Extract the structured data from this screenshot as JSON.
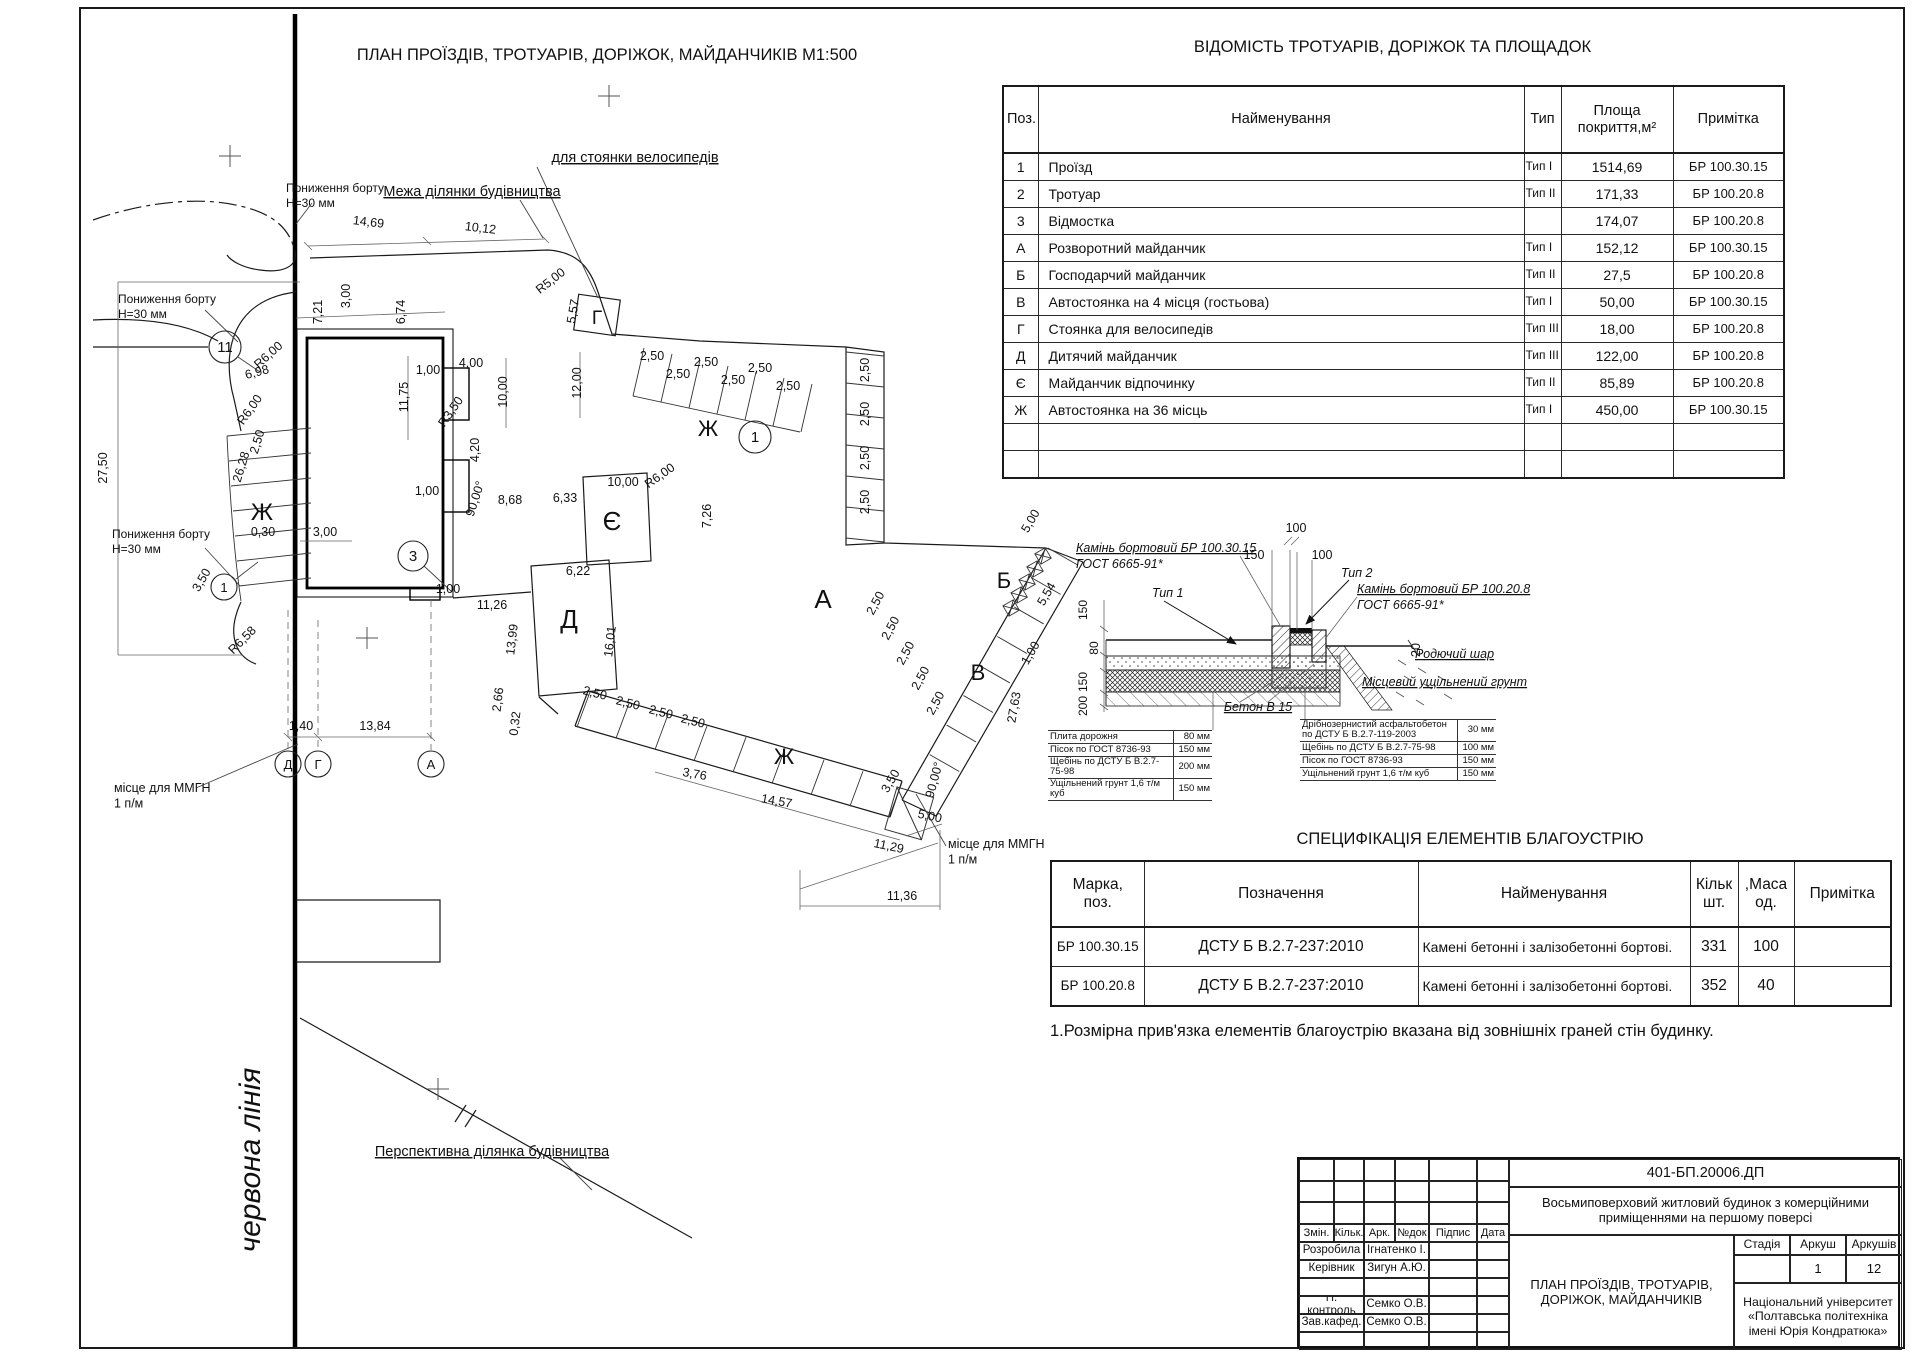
{
  "sheet": {
    "note": "1.Розмірна прив'язка елементів благоустрію вказана від зовнішніх граней стін будинку."
  },
  "plan": {
    "labels": [
      {
        "t": "ПЛАН ПРОЇЗДІВ, ТРОТУАРІВ, ДОРІЖОК, МАЙДАНЧИКІВ М1:500",
        "x": 607,
        "y": 60,
        "s": 16.5,
        "n": "plan-title"
      },
      {
        "t": "для стоянки велосипедів",
        "x": 635,
        "y": 162,
        "s": 14.5,
        "u": 1,
        "n": "callout-bike-parking"
      },
      {
        "t": "Межа ділянки будівництва",
        "x": 472,
        "y": 196,
        "s": 14.5,
        "u": 1,
        "n": "callout-site-boundary"
      },
      {
        "t": "Пониження борту\nН=30 мм",
        "x": 286,
        "y": 192,
        "s": 12,
        "a": "start",
        "n": "callout-curb-lowering"
      },
      {
        "t": "Пониження борту\nН=30 мм",
        "x": 118,
        "y": 303,
        "s": 12,
        "a": "start",
        "n": "callout-curb-lowering"
      },
      {
        "t": "Пониження борту\nН=30 мм",
        "x": 112,
        "y": 538,
        "s": 12,
        "a": "start",
        "n": "callout-curb-lowering"
      },
      {
        "t": "місце для ММГН\n1 п/м",
        "x": 114,
        "y": 792,
        "s": 12.5,
        "a": "start",
        "n": "callout-mmgn"
      },
      {
        "t": "місце для ММГН\n1 п/м",
        "x": 948,
        "y": 848,
        "s": 12.5,
        "a": "start",
        "n": "callout-mmgn"
      },
      {
        "t": "Перспективна ділянка будівництва",
        "x": 492,
        "y": 1156,
        "s": 14.5,
        "u": 1,
        "n": "callout-perspective-site"
      },
      {
        "t": "червона лінія",
        "x": 260,
        "y": 1160,
        "r": -90,
        "s": 30,
        "i": 1,
        "serif": 1,
        "n": "red-line-label"
      },
      {
        "t": "Ж",
        "x": 262,
        "y": 520,
        "s": 24,
        "n": "area-letter"
      },
      {
        "t": "Ж",
        "x": 708,
        "y": 436,
        "s": 22,
        "n": "area-letter"
      },
      {
        "t": "Ж",
        "x": 784,
        "y": 764,
        "s": 22,
        "n": "area-letter"
      },
      {
        "t": "А",
        "x": 823,
        "y": 608,
        "s": 26,
        "n": "area-letter"
      },
      {
        "t": "Б",
        "x": 1004,
        "y": 588,
        "s": 22,
        "n": "area-letter"
      },
      {
        "t": "В",
        "x": 978,
        "y": 680,
        "s": 22,
        "n": "area-letter"
      },
      {
        "t": "Д",
        "x": 569,
        "y": 628,
        "s": 26,
        "n": "area-letter"
      },
      {
        "t": "Є",
        "x": 612,
        "y": 530,
        "s": 26,
        "n": "area-letter"
      },
      {
        "t": "Г",
        "x": 597,
        "y": 324,
        "s": 19,
        "n": "area-letter"
      },
      {
        "t": "14,69",
        "x": 368,
        "y": 226,
        "r": 7
      },
      {
        "t": "10,12",
        "x": 480,
        "y": 232,
        "r": 7
      },
      {
        "t": "R5,00",
        "x": 553,
        "y": 284,
        "r": -38
      },
      {
        "t": "5,57",
        "x": 577,
        "y": 312,
        "r": -80
      },
      {
        "t": "7,21",
        "x": 322,
        "y": 312,
        "r": -90
      },
      {
        "t": "3,00",
        "x": 350,
        "y": 296,
        "r": -90
      },
      {
        "t": "6,74",
        "x": 405,
        "y": 312,
        "r": -90
      },
      {
        "t": "1,00",
        "x": 428,
        "y": 374
      },
      {
        "t": "4,00",
        "x": 471,
        "y": 367
      },
      {
        "t": "11,75",
        "x": 408,
        "y": 397,
        "r": -90
      },
      {
        "t": "10,00",
        "x": 507,
        "y": 392,
        "r": -90
      },
      {
        "t": "12,00",
        "x": 581,
        "y": 383,
        "r": -90
      },
      {
        "t": "R3,50",
        "x": 454,
        "y": 414,
        "r": -55
      },
      {
        "t": "4,20",
        "x": 479,
        "y": 450,
        "r": -90
      },
      {
        "t": "90,00°",
        "x": 479,
        "y": 500,
        "r": -72
      },
      {
        "t": "8,68",
        "x": 510,
        "y": 504
      },
      {
        "t": "6,33",
        "x": 565,
        "y": 502
      },
      {
        "t": "10,00",
        "x": 623,
        "y": 486
      },
      {
        "t": "R6,00",
        "x": 662,
        "y": 479,
        "r": -35
      },
      {
        "t": "7,26",
        "x": 711,
        "y": 516,
        "r": -90
      },
      {
        "t": "R6,00",
        "x": 271,
        "y": 358,
        "r": -42
      },
      {
        "t": "6,98",
        "x": 258,
        "y": 376,
        "r": -15
      },
      {
        "t": "R6,00",
        "x": 253,
        "y": 412,
        "r": -55
      },
      {
        "t": "26,28",
        "x": 245,
        "y": 468,
        "r": -73
      },
      {
        "t": "2,50",
        "x": 261,
        "y": 443,
        "r": -73
      },
      {
        "t": "27,50",
        "x": 107,
        "y": 468,
        "r": -90
      },
      {
        "t": "0,30",
        "x": 263,
        "y": 536
      },
      {
        "t": "3,00",
        "x": 325,
        "y": 536
      },
      {
        "t": "3,50",
        "x": 205,
        "y": 582,
        "r": -60
      },
      {
        "t": "R6,58",
        "x": 245,
        "y": 643,
        "r": -45
      },
      {
        "t": "1,00",
        "x": 427,
        "y": 495
      },
      {
        "t": "1,00",
        "x": 448,
        "y": 593
      },
      {
        "t": "6,22",
        "x": 578,
        "y": 575
      },
      {
        "t": "11,26",
        "x": 492,
        "y": 609
      },
      {
        "t": "13,99",
        "x": 516,
        "y": 640,
        "r": -83
      },
      {
        "t": "16,01",
        "x": 614,
        "y": 642,
        "r": -83
      },
      {
        "t": "2,66",
        "x": 502,
        "y": 700,
        "r": -83
      },
      {
        "t": "0,32",
        "x": 519,
        "y": 724,
        "r": -83
      },
      {
        "t": "1,40",
        "x": 301,
        "y": 730
      },
      {
        "t": "13,84",
        "x": 375,
        "y": 730
      },
      {
        "t": "3,76",
        "x": 694,
        "y": 778,
        "r": 10
      },
      {
        "t": "14,57",
        "x": 776,
        "y": 805,
        "r": 10
      },
      {
        "t": "11,29",
        "x": 888,
        "y": 850,
        "r": 12
      },
      {
        "t": "11,36",
        "x": 902,
        "y": 900
      },
      {
        "t": "5,00",
        "x": 929,
        "y": 820,
        "r": 12
      },
      {
        "t": "90,00°",
        "x": 938,
        "y": 781,
        "r": -75
      },
      {
        "t": "3,50",
        "x": 894,
        "y": 783,
        "r": -60
      },
      {
        "t": "5,00",
        "x": 1034,
        "y": 523,
        "r": -60
      },
      {
        "t": "5,54",
        "x": 1050,
        "y": 596,
        "r": -60
      },
      {
        "t": "1,00",
        "x": 1034,
        "y": 655,
        "r": -60
      },
      {
        "t": "27,63",
        "x": 1018,
        "y": 708,
        "r": -80
      },
      {
        "t": "2,50",
        "x": 652,
        "y": 360
      },
      {
        "t": "2,50",
        "x": 678,
        "y": 378
      },
      {
        "t": "2,50",
        "x": 706,
        "y": 366
      },
      {
        "t": "2,50",
        "x": 733,
        "y": 384
      },
      {
        "t": "2,50",
        "x": 760,
        "y": 372
      },
      {
        "t": "2,50",
        "x": 788,
        "y": 390
      },
      {
        "t": "2,50",
        "x": 869,
        "y": 370,
        "r": -90
      },
      {
        "t": "2,50",
        "x": 869,
        "y": 414,
        "r": -90
      },
      {
        "t": "2,50",
        "x": 869,
        "y": 458,
        "r": -90
      },
      {
        "t": "2,50",
        "x": 869,
        "y": 502,
        "r": -90
      },
      {
        "t": "2,50",
        "x": 879,
        "y": 605,
        "r": -62
      },
      {
        "t": "2,50",
        "x": 894,
        "y": 630,
        "r": -62
      },
      {
        "t": "2,50",
        "x": 909,
        "y": 655,
        "r": -62
      },
      {
        "t": "2,50",
        "x": 924,
        "y": 680,
        "r": -62
      },
      {
        "t": "2,50",
        "x": 939,
        "y": 705,
        "r": -62
      },
      {
        "t": "2,50",
        "x": 594,
        "y": 697,
        "r": 14
      },
      {
        "t": "2,50",
        "x": 627,
        "y": 707,
        "r": 14
      },
      {
        "t": "2,50",
        "x": 660,
        "y": 716,
        "r": 14
      },
      {
        "t": "2,50",
        "x": 692,
        "y": 725,
        "r": 14
      }
    ],
    "bubbles": [
      {
        "t": "11",
        "x": 225,
        "y": 347,
        "r": 16
      },
      {
        "t": "1",
        "x": 755,
        "y": 437,
        "r": 16
      },
      {
        "t": "3",
        "x": 413,
        "y": 556,
        "r": 15
      },
      {
        "t": "1",
        "x": 224,
        "y": 587,
        "r": 13
      },
      {
        "t": "Д",
        "x": 288,
        "y": 764,
        "r": 13
      },
      {
        "t": "Г",
        "x": 318,
        "y": 764,
        "r": 13
      },
      {
        "t": "А",
        "x": 431,
        "y": 764,
        "r": 13
      }
    ]
  },
  "vedomist": {
    "title": "ВІДОМІСТЬ ТРОТУАРІВ, ДОРІЖОК ТА ПЛОЩАДОК",
    "headers": [
      "Поз.",
      "Найменування",
      "Тип",
      "Площа\nпокриття,м²",
      "Примітка"
    ],
    "rows": [
      [
        "1",
        "Проїзд",
        "Тип I",
        "1514,69",
        "БР 100.30.15"
      ],
      [
        "2",
        "Тротуар",
        "Тип II",
        "171,33",
        "БР 100.20.8"
      ],
      [
        "3",
        "Відмостка",
        "",
        "174,07",
        "БР 100.20.8"
      ],
      [
        "А",
        "Розворотний майданчик",
        "Тип I",
        "152,12",
        "БР 100.30.15"
      ],
      [
        "Б",
        "Господарчий майданчик",
        "Тип II",
        "27,5",
        "БР 100.20.8"
      ],
      [
        "В",
        "Автостоянка на 4 місця (гостьова)",
        "Тип I",
        "50,00",
        "БР 100.30.15"
      ],
      [
        "Г",
        "Стоянка для велосипедів",
        "Тип III",
        "18,00",
        "БР 100.20.8"
      ],
      [
        "Д",
        "Дитячий майданчик",
        "Тип III",
        "122,00",
        "БР 100.20.8"
      ],
      [
        "Є",
        "Майданчик відпочинку",
        "Тип II",
        "85,89",
        "БР 100.20.8"
      ],
      [
        "Ж",
        "Автостоянка на 36 місць",
        "Тип I",
        "450,00",
        "БР 100.30.15"
      ],
      [
        "",
        "",
        "",
        "",
        ""
      ],
      [
        "",
        "",
        "",
        "",
        ""
      ]
    ]
  },
  "detail": {
    "labels": [
      {
        "t": "Камінь бортовий БР 100.30.15",
        "x": 1076,
        "y": 552,
        "a": "start",
        "i": 1,
        "u": 1
      },
      {
        "t": "ГОСТ 6665-91*",
        "x": 1076,
        "y": 568,
        "a": "start",
        "i": 1
      },
      {
        "t": "Тип 1",
        "x": 1152,
        "y": 597,
        "a": "start",
        "i": 1
      },
      {
        "t": "100",
        "x": 1296,
        "y": 532
      },
      {
        "t": "150",
        "x": 1254,
        "y": 559
      },
      {
        "t": "100",
        "x": 1322,
        "y": 559
      },
      {
        "t": "Тип 2",
        "x": 1341,
        "y": 577,
        "a": "start",
        "i": 1
      },
      {
        "t": "Камінь бортовий БР 100.20.8",
        "x": 1357,
        "y": 593,
        "a": "start",
        "i": 1,
        "u": 1
      },
      {
        "t": "ГОСТ 6665-91*",
        "x": 1357,
        "y": 609,
        "a": "start",
        "i": 1
      },
      {
        "t": "Родючий шар",
        "x": 1415,
        "y": 658,
        "a": "start",
        "i": 1,
        "u": 1
      },
      {
        "t": "Місцевий ущільнений грунт",
        "x": 1362,
        "y": 686,
        "a": "start",
        "i": 1,
        "u": 1
      },
      {
        "t": "Бетон В 15",
        "x": 1258,
        "y": 711,
        "i": 1,
        "u": 1
      },
      {
        "t": "20",
        "x": 1420,
        "y": 650,
        "r": -90
      },
      {
        "t": "150",
        "x": 1087,
        "y": 610,
        "r": -90,
        "s": 12
      },
      {
        "t": "80",
        "x": 1098,
        "y": 648,
        "r": -90,
        "s": 12
      },
      {
        "t": "150",
        "x": 1087,
        "y": 682,
        "r": -90,
        "s": 12
      },
      {
        "t": "200",
        "x": 1087,
        "y": 706,
        "r": -90,
        "s": 12
      }
    ],
    "layers_left": [
      [
        "Плита дорожня",
        "80 мм"
      ],
      [
        "Пісок по ГОСТ 8736-93",
        "150 мм"
      ],
      [
        "Щебінь по ДСТУ Б В.2.7-75-98",
        "200 мм"
      ],
      [
        "Ущільнений грунт 1,6 т/м куб",
        "150 мм"
      ]
    ],
    "layers_right": [
      [
        "Дрібнозернистий асфальтобетон\nпо ДСТУ Б В.2.7-119-2003",
        "30 мм"
      ],
      [
        "Щебінь по ДСТУ Б В.2.7-75-98",
        "100 мм"
      ],
      [
        "Пісок по ГОСТ 8736-93",
        "150 мм"
      ],
      [
        "Ущільнений грунт 1,6 т/м куб",
        "150 мм"
      ]
    ]
  },
  "spec": {
    "title": "СПЕЦИФІКАЦІЯ ЕЛЕМЕНТІВ БЛАГОУСТРІЮ",
    "headers": [
      "Марка,\nпоз.",
      "Позначення",
      "Найменування",
      "Кільк\nшт.",
      ",Маса\nод.",
      "Примітка"
    ],
    "rows": [
      [
        "БР 100.30.15",
        "ДСТУ Б В.2.7-237:2010",
        "Камені бетонні і залізобетонні бортові.",
        "331",
        "100",
        ""
      ],
      [
        "БР 100.20.8",
        "ДСТУ Б В.2.7-237:2010",
        "Камені бетонні і залізобетонні бортові.",
        "352",
        "40",
        ""
      ]
    ]
  },
  "titleblock": {
    "doc_number": "401-БП.20006.ДП",
    "project": "Восьмиповерховий житловий будинок з комерційними приміщеннями на першому поверсі",
    "sheet_title": "ПЛАН ПРОЇЗДІВ, ТРОТУАРІВ, ДОРІЖОК, МАЙДАНЧИКІВ",
    "university": "Національний університет «Полтавська політехніка імені Юрія Кондратюка»",
    "cols": [
      "Змін.",
      "Кільк.",
      "Арк.",
      "№док",
      "Підпис",
      "Дата"
    ],
    "roles": [
      [
        "Розробила",
        "Ігнатенко І."
      ],
      [
        "Керівник",
        "Зигун А.Ю."
      ],
      [
        "",
        ""
      ],
      [
        "Н. контроль",
        "Семко О.В."
      ],
      [
        "Зав.кафед.",
        "Семко О.В."
      ]
    ],
    "stage_headers": [
      "Стадія",
      "Аркуш",
      "Аркушів"
    ],
    "stage_values": [
      "",
      "1",
      "12"
    ]
  }
}
